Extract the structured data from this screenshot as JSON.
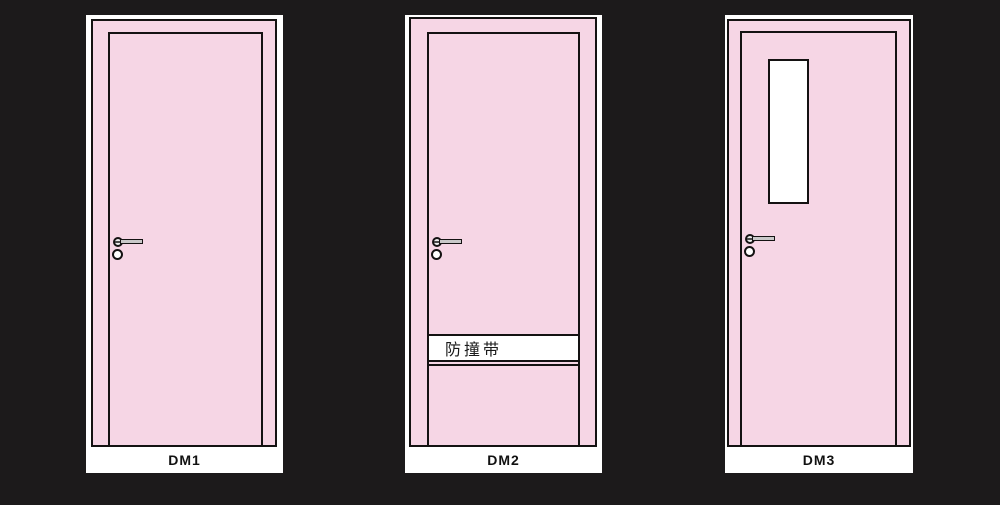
{
  "background_color": "#1c1a1b",
  "colors": {
    "door_fill": "#f6d6e5",
    "outline": "#141212",
    "card": "#ffffff",
    "hardware_fill": "#c9c9c9",
    "strip_fill": "#ffffff",
    "strip_text_color": "#1a1a1a"
  },
  "doors": [
    {
      "label": "DM1",
      "parts": [
        "door-frame",
        "door-leaf",
        "lever-handle",
        "lock-cylinder"
      ]
    },
    {
      "label": "DM2",
      "strip_text": "防撞带",
      "parts": [
        "door-frame",
        "door-leaf",
        "lever-handle",
        "lock-cylinder",
        "bumper-strip"
      ]
    },
    {
      "label": "DM3",
      "parts": [
        "door-frame",
        "door-leaf",
        "lever-handle",
        "lock-cylinder",
        "vision-panel"
      ]
    }
  ]
}
